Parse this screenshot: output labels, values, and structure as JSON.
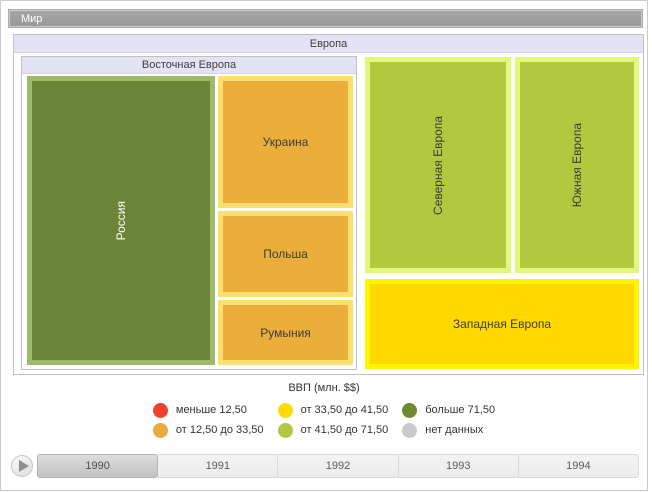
{
  "window": {
    "title": "Мир"
  },
  "treemap": {
    "root_label": "Европа",
    "group_label": "Восточная Европа",
    "cells": {
      "russia": {
        "label": "Россия"
      },
      "ukraine": {
        "label": "Украина"
      },
      "poland": {
        "label": "Польша"
      },
      "romania": {
        "label": "Румыния"
      },
      "northern": {
        "label": "Северная Европа"
      },
      "southern": {
        "label": "Южная Европа"
      },
      "western": {
        "label": "Западная Европа"
      }
    }
  },
  "legend": {
    "title": "ВВП (млн. $$)",
    "items": [
      {
        "label": "меньше 12,50",
        "color": "#f2402c"
      },
      {
        "label": "от 12,50 до 33,50",
        "color": "#e9aa3e"
      },
      {
        "label": "от 33,50 до 41,50",
        "color": "#ffdc00"
      },
      {
        "label": "от 41,50 до 71,50",
        "color": "#afc847"
      },
      {
        "label": "больше 71,50",
        "color": "#6e8a33"
      },
      {
        "label": "нет данных",
        "color": "#c9c9c9"
      }
    ]
  },
  "timeline": {
    "years": [
      "1990",
      "1991",
      "1992",
      "1993",
      "1994"
    ],
    "selected": "1990",
    "play_icon": "play-triangle"
  },
  "colors": {
    "cell_fills": {
      "russia": "#6c8639",
      "russia_border": "#9eba6b",
      "orange": "#ebae3b",
      "orange_border": "#fbdf70",
      "light_green": "#b2c83f",
      "light_green_border": "#e3f77e",
      "yellow": "#ffd800",
      "yellow_border": "#fff400"
    },
    "header_bg": "#e3e3f3",
    "world_bar_bg": "#9d9d9d"
  },
  "chart_data": {
    "type": "treemap",
    "title": "ВВП (млн. $$)",
    "root": "Европа",
    "nodes": [
      {
        "name": "Россия",
        "group": "Восточная Европа",
        "gdp_bin": "больше 71,50",
        "fill": "#6c8639"
      },
      {
        "name": "Украина",
        "group": "Восточная Европа",
        "gdp_bin": "от 12,50 до 33,50",
        "fill": "#ebae3b"
      },
      {
        "name": "Польша",
        "group": "Восточная Европа",
        "gdp_bin": "от 12,50 до 33,50",
        "fill": "#ebae3b"
      },
      {
        "name": "Румыния",
        "group": "Восточная Европа",
        "gdp_bin": "от 12,50 до 33,50",
        "fill": "#ebae3b"
      },
      {
        "name": "Северная Европа",
        "group": "Европа",
        "gdp_bin": "от 41,50 до 71,50",
        "fill": "#b2c83f"
      },
      {
        "name": "Южная Европа",
        "group": "Европа",
        "gdp_bin": "от 41,50 до 71,50",
        "fill": "#b2c83f"
      },
      {
        "name": "Западная Европа",
        "group": "Европа",
        "gdp_bin": "от 33,50 до 41,50",
        "fill": "#ffd800"
      }
    ],
    "legend_bins": [
      "меньше 12,50",
      "от 12,50 до 33,50",
      "от 33,50 до 41,50",
      "от 41,50 до 71,50",
      "больше 71,50",
      "нет данных"
    ],
    "timeline_years": [
      "1990",
      "1991",
      "1992",
      "1993",
      "1994"
    ],
    "selected_year": "1990"
  }
}
